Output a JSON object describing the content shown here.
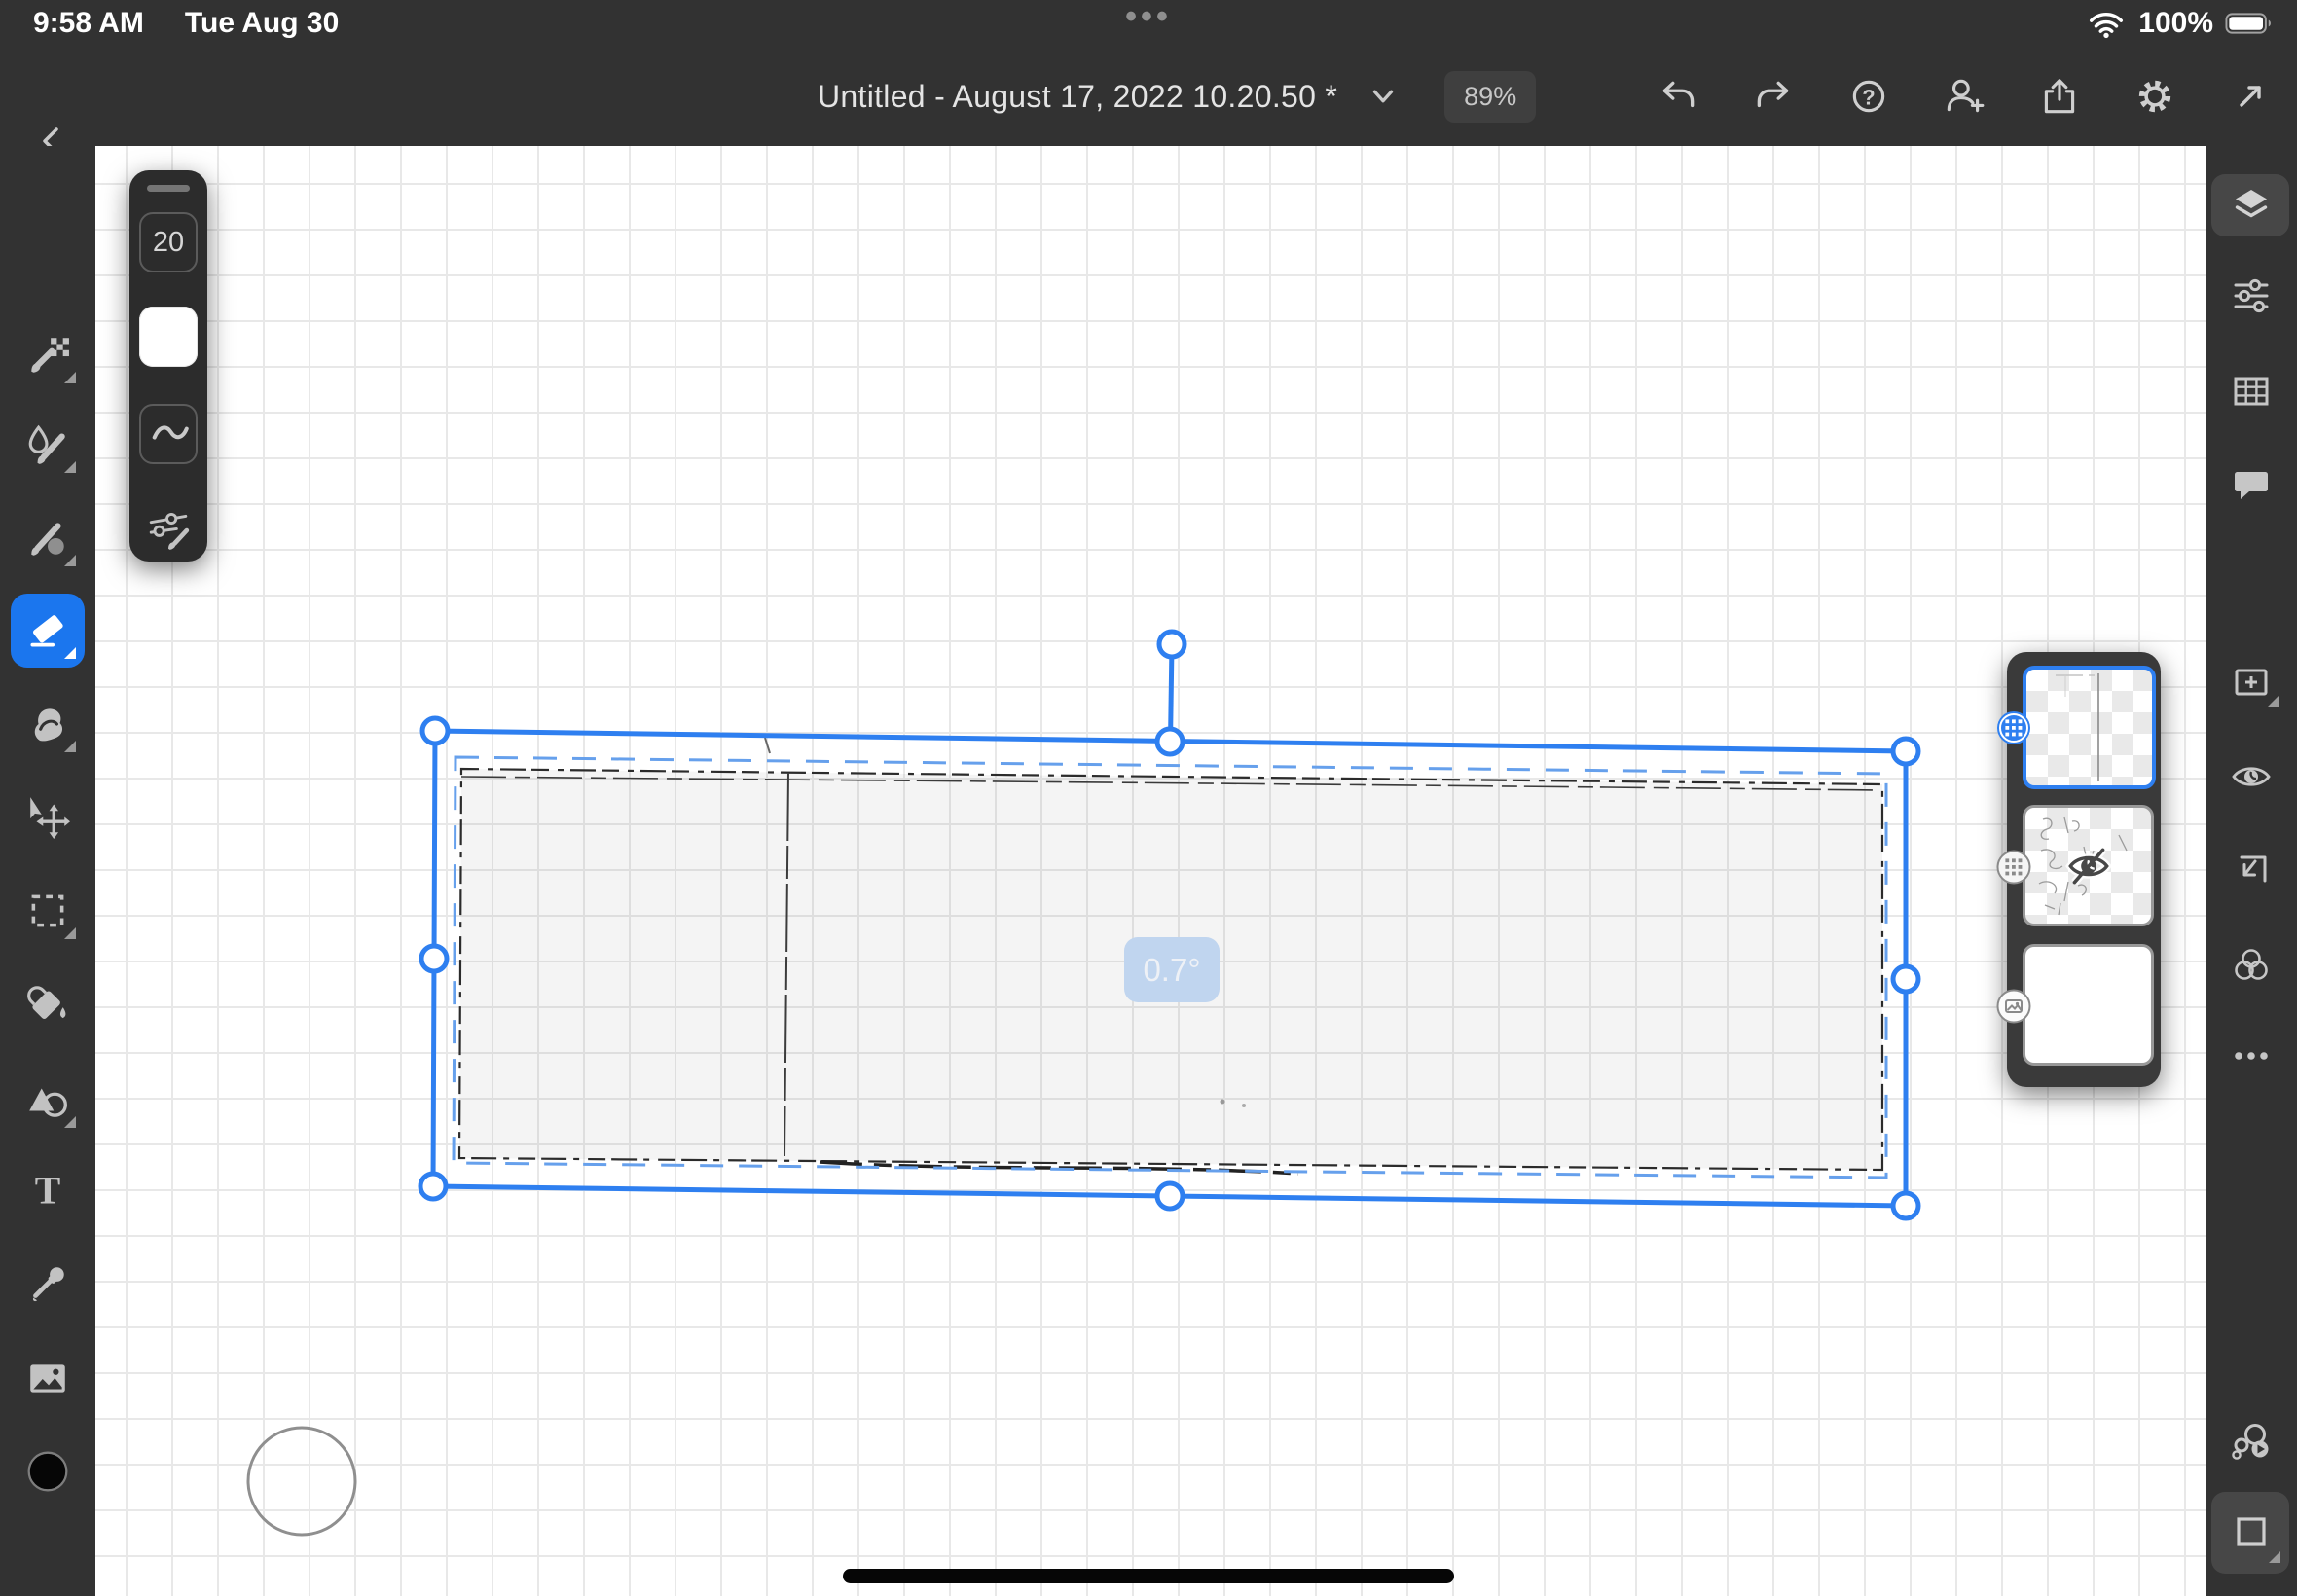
{
  "status_bar": {
    "time": "9:58 AM",
    "date": "Tue Aug 30",
    "ellipsis": "•••",
    "battery_percent": "100%"
  },
  "header": {
    "title": "Untitled - August 17, 2022 10.20.50 *",
    "zoom_level": "89%"
  },
  "icons": {
    "help_glyph": "?",
    "text_tool_glyph": "T"
  },
  "tool_options": {
    "brush_size": "20",
    "swatch_color": "#ffffff"
  },
  "left_toolbar": {
    "tools": [
      {
        "name": "pixel-brush",
        "selected": false,
        "has_flyout": true
      },
      {
        "name": "live-brush",
        "selected": false,
        "has_flyout": true
      },
      {
        "name": "mixer-brush",
        "selected": false,
        "has_flyout": true
      },
      {
        "name": "eraser",
        "selected": true,
        "has_flyout": true
      },
      {
        "name": "smudge",
        "selected": false,
        "has_flyout": true
      },
      {
        "name": "move-transform",
        "selected": false,
        "has_flyout": false
      },
      {
        "name": "marquee-select",
        "selected": false,
        "has_flyout": true
      },
      {
        "name": "fill",
        "selected": false,
        "has_flyout": false
      },
      {
        "name": "shapes",
        "selected": false,
        "has_flyout": true
      },
      {
        "name": "text",
        "selected": false,
        "has_flyout": false
      },
      {
        "name": "eyedropper",
        "selected": false,
        "has_flyout": false
      },
      {
        "name": "place-image",
        "selected": false,
        "has_flyout": false
      },
      {
        "name": "color-well",
        "selected": false,
        "value": "#000000"
      }
    ]
  },
  "right_sidebar": {
    "items": [
      "layers",
      "adjustments",
      "precision-grid",
      "comments",
      "add-layer",
      "layer-visibility",
      "merge-down",
      "blend-modes",
      "more-options",
      "timelapse",
      "touch-shortcut"
    ],
    "selected": "layers"
  },
  "layers_panel": {
    "layers": [
      {
        "type": "pixel-layer",
        "selected": true,
        "hidden": false,
        "badge": "pixel-grid"
      },
      {
        "type": "pixel-layer",
        "selected": false,
        "hidden": true,
        "badge": "pixel-grid"
      },
      {
        "type": "background-layer",
        "selected": false,
        "hidden": false,
        "badge": "image"
      }
    ]
  },
  "canvas": {
    "rotation_badge": "0.7°",
    "selection": "sketched-rectangle",
    "grid_visible": true
  },
  "colors": {
    "ui_bg": "#323232",
    "accent_blue": "#1b76ee",
    "selection_blue": "#2e7ff0",
    "rotation_badge_bg": "#c0d5ef",
    "canvas_bg": "#ffffff",
    "grid_line": "#e8e8e8"
  }
}
